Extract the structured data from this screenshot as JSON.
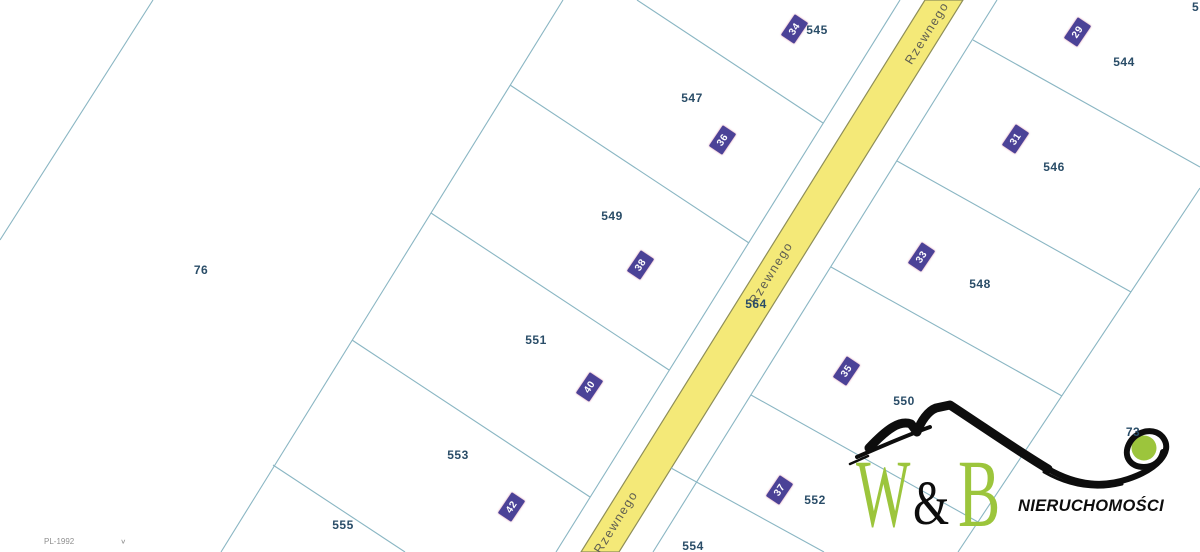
{
  "map": {
    "crs_selector": {
      "label": "PL-1992",
      "chevron_icon": "∨"
    },
    "road": {
      "name": "Rzewnego"
    },
    "parcel_labels": [
      "76",
      "545",
      "547",
      "549",
      "551",
      "553",
      "555",
      "544",
      "546",
      "548",
      "550",
      "552",
      "554",
      "564",
      "73"
    ],
    "corner_partial_label": "5",
    "address_markers": [
      "34",
      "36",
      "38",
      "40",
      "42",
      "29",
      "31",
      "33",
      "35",
      "37"
    ]
  },
  "watermark": {
    "letter_w": "W",
    "ampersand": "&",
    "letter_b": "B",
    "subtitle": "NIERUCHOMOŚCI"
  },
  "colors": {
    "parcel_line": "#8ab6c3",
    "road_fill": "#f4e978",
    "road_outline": "#8e8e58",
    "road_text": "#5f5f52",
    "label_text": "#2a4d68",
    "marker_bg": "#4b4297",
    "marker_text": "#ffffff",
    "crs_text": "#8f8f8f",
    "logo_green": "#9cc53c",
    "logo_black": "#0d0d0d"
  }
}
